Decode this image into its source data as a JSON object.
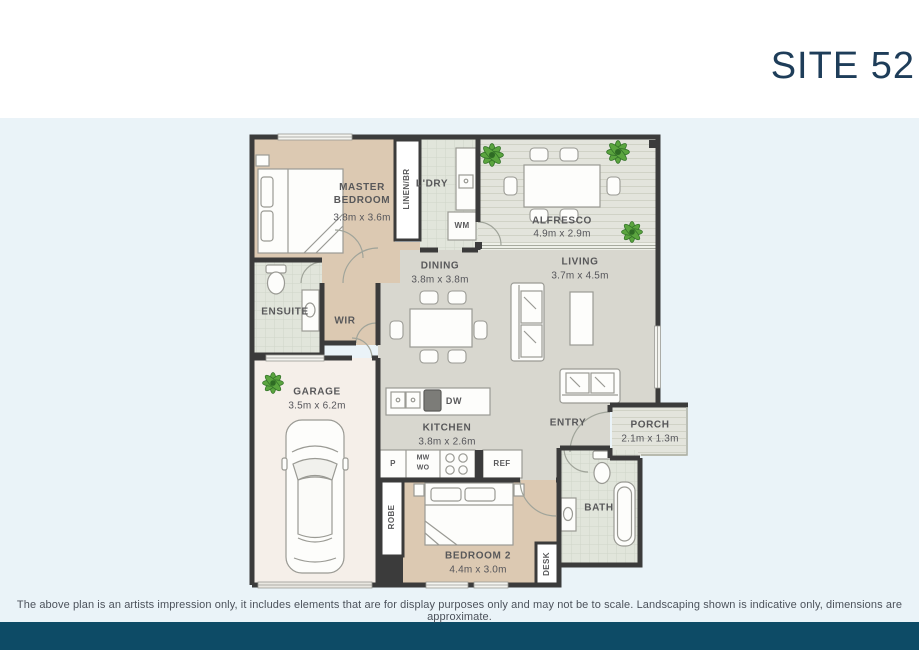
{
  "header": {
    "title": "SITE 52"
  },
  "footer": {
    "disclaimer": "The above plan is an artists impression only, it includes elements that are for display purposes only and may not be to scale. Landscaping shown is indicative only, dimensions are approximate."
  },
  "colors": {
    "accent_navy": "#0d4b66",
    "title_navy": "#1e3d59",
    "background_blue": "#eaf3f8",
    "wall": "#3b3b3b",
    "floor_tan": "#dcc9b2",
    "floor_gray": "#d8d7cf",
    "floor_tile": "#e1e5db",
    "floor_outdoor": "#e3e4dc",
    "floor_garage": "#f5efe9",
    "plant_green": "#5ba53f"
  },
  "rooms": {
    "master": {
      "name": "MASTER BEDROOM",
      "dims": "3.8m x 3.6m"
    },
    "linen": {
      "name": "LINEN/BR"
    },
    "laundry": {
      "name": "L'DRY"
    },
    "alfresco": {
      "name": "ALFRESCO",
      "dims": "4.9m x 2.9m"
    },
    "dining": {
      "name": "DINING",
      "dims": "3.8m x 3.8m"
    },
    "living": {
      "name": "LIVING",
      "dims": "3.7m x 4.5m"
    },
    "ensuite": {
      "name": "ENSUITE"
    },
    "wir": {
      "name": "WIR"
    },
    "garage": {
      "name": "GARAGE",
      "dims": "3.5m x 6.2m"
    },
    "kitchen": {
      "name": "KITCHEN",
      "dims": "3.8m x 2.6m"
    },
    "entry": {
      "name": "ENTRY"
    },
    "porch": {
      "name": "PORCH",
      "dims": "2.1m x 1.3m"
    },
    "bath": {
      "name": "BATH"
    },
    "bedroom2": {
      "name": "BEDROOM 2",
      "dims": "4.4m x 3.0m"
    },
    "robe": {
      "name": "ROBE"
    },
    "desk": {
      "name": "DESK"
    }
  },
  "fixtures": {
    "wm": "WM",
    "dw": "DW",
    "ref": "REF",
    "pantry": "P",
    "microwave": "MW",
    "wall_oven": "WO"
  }
}
